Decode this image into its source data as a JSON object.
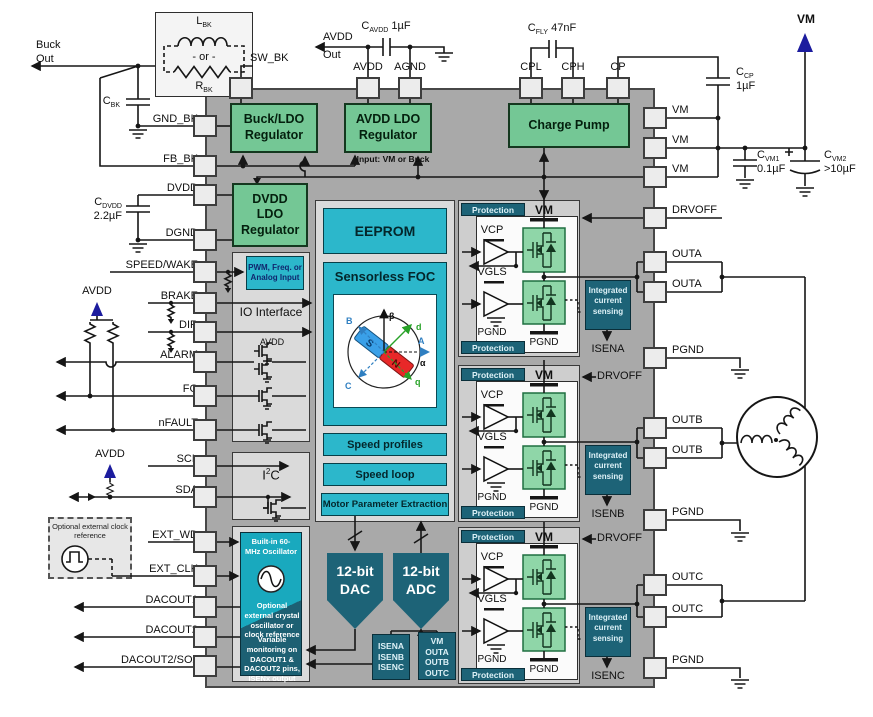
{
  "external": {
    "buck_out_line1": "Buck",
    "buck_out_line2": "Out",
    "l_bk": {
      "main": "L",
      "sub": "BK"
    },
    "or_label": "- or -",
    "r_bk": {
      "main": "R",
      "sub": "BK"
    },
    "c_bk": {
      "main": "C",
      "sub": "BK"
    },
    "c_dvdd": {
      "main": "C",
      "sub": "DVDD",
      "value": "2.2µF"
    },
    "avdd_out_line1": "AVDD",
    "avdd_out_line2": "Out",
    "c_avdd": {
      "main": "C",
      "sub": "AVDD",
      "value": "1µF"
    },
    "c_fly": {
      "main": "C",
      "sub": "FLY",
      "value": "47nF"
    },
    "c_cp": {
      "main": "C",
      "sub": "CP",
      "value": "1µF"
    },
    "vm_label": "VM",
    "c_vm1": {
      "main": "C",
      "sub": "VM1",
      "value": "0.1µF"
    },
    "c_vm2": {
      "main": "C",
      "sub": "VM2",
      "value": ">10µF"
    },
    "plus": "+",
    "avdd_pullup": "AVDD",
    "avdd_sda": "AVDD",
    "clock_ref": "Optional external clock reference"
  },
  "pins": {
    "top": [
      "SW_BK",
      "AVDD",
      "AGND",
      "CPL",
      "CPH",
      "CP"
    ],
    "left": [
      "GND_BK",
      "FB_BK",
      "DVDD",
      "DGND",
      "SPEED/WAKE",
      "BRAKE",
      "DIR",
      "ALARM",
      "FG",
      "nFAULT",
      "SCL",
      "SDA",
      "EXT_WD",
      "EXT_CLK",
      "DACOUT1",
      "DACOUT2",
      "DACOUT2/SOx"
    ],
    "right": [
      "VM",
      "VM",
      "VM",
      "DRVOFF",
      "OUTA",
      "OUTA",
      "PGND",
      "OUTB",
      "OUTB",
      "PGND",
      "OUTC",
      "OUTC",
      "PGND"
    ]
  },
  "blocks": {
    "buck_ldo": "Buck/LDO Regulator",
    "avdd_ldo": "AVDD LDO Regulator",
    "avdd_ldo_note": "Input: VM or Buck",
    "charge_pump": "Charge Pump",
    "dvdd_ldo": "DVDD LDO Regulator",
    "pwm_input": "PWM, Freq. or Analog Input",
    "io_interface": "IO Interface",
    "io_avdd": "AVDD",
    "eeprom": "EEPROM",
    "foc_title": "Sensorless FOC",
    "speed_profiles": "Speed profiles",
    "speed_loop": "Speed loop",
    "mpe": "Motor Parameter Extraction",
    "i2c": {
      "pre": "I",
      "sup": "2",
      "post": "C"
    },
    "osc_top": "Built-in 60-MHz Oscillator",
    "osc_mid": "Optional external crystal oscillator or clock reference",
    "osc_bottom": "Variable monitoring on DACOUT1 & DACOUT2 pins, ISENx output",
    "dac_line1": "12-bit",
    "dac_line2": "DAC",
    "adc_line1": "12-bit",
    "adc_line2": "ADC",
    "isen_mux": [
      "ISENA",
      "ISENB",
      "ISENC"
    ],
    "vm_mux": [
      "VM",
      "OUTA",
      "OUTB",
      "OUTC"
    ]
  },
  "phases": [
    {
      "protection_top": "Protection",
      "protection_bottom": "Protection",
      "vm": "VM",
      "vcp": "VCP",
      "vgls": "VGLS",
      "pgnd_left": "PGND",
      "pgnd_bottom": "PGND",
      "ics": [
        "Integrated",
        "current",
        "sensing"
      ],
      "isen": "ISENA"
    },
    {
      "protection_top": "Protection",
      "protection_bottom": "Protection",
      "vm": "VM",
      "vcp": "VCP",
      "vgls": "VGLS",
      "pgnd_left": "PGND",
      "pgnd_bottom": "PGND",
      "ics": [
        "Integrated",
        "current",
        "sensing"
      ],
      "isen": "ISENB",
      "drvoff": "DRVOFF"
    },
    {
      "protection_top": "Protection",
      "protection_bottom": "Protection",
      "vm": "VM",
      "vcp": "VCP",
      "vgls": "VGLS",
      "pgnd_left": "PGND",
      "pgnd_bottom": "PGND",
      "ics": [
        "Integrated",
        "current",
        "sensing"
      ],
      "isen": "ISENC",
      "drvoff": "DRVOFF"
    }
  ],
  "foc": {
    "beta": "β",
    "alpha": "α",
    "axis_a": "A",
    "axis_b": "B",
    "axis_c": "C",
    "axis_d": "d",
    "axis_q": "q",
    "south": "S",
    "north": "N"
  },
  "colors": {
    "accent_green": "#74c795",
    "accent_cyan": "#2cb7cb",
    "accent_teal": "#1d6377",
    "chip_gray": "#a9a9a9",
    "arrow_blue": "#1c1c9e"
  }
}
